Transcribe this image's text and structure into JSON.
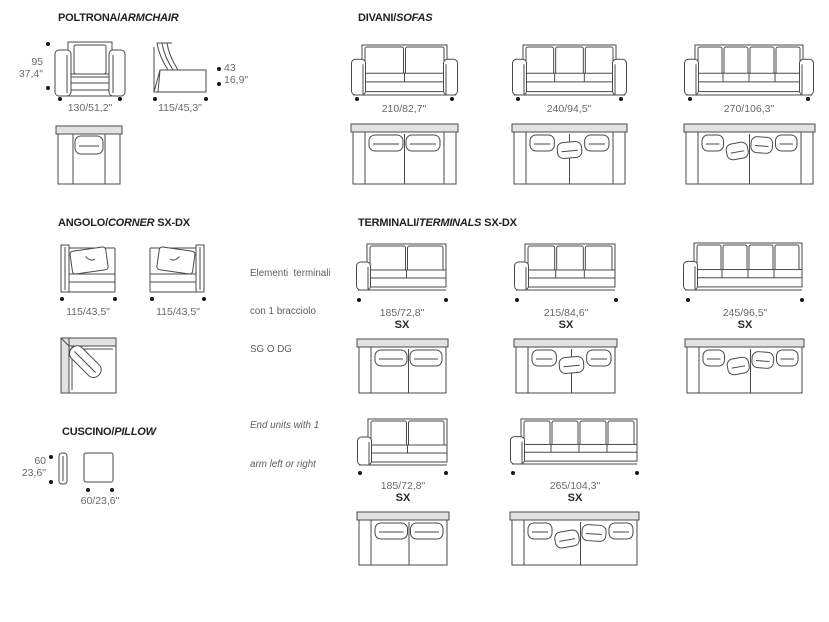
{
  "page": {
    "width": 829,
    "height": 622,
    "background": "#ffffff"
  },
  "colors": {
    "line": "#4a4a4b",
    "shade": "#e2e2e2",
    "text_gray": "#67686a",
    "text_dark": "#222222"
  },
  "sections": {
    "poltrona": {
      "title_main": "POLTRONA/",
      "title_italic": "ARMCHAIR",
      "title_suffix": ""
    },
    "divani": {
      "title_main": "DIVANI/",
      "title_italic": "SOFAS",
      "title_suffix": ""
    },
    "angolo": {
      "title_main": "ANGOLO/",
      "title_italic": "CORNER",
      "title_suffix": " SX-DX"
    },
    "terminali": {
      "title_main": "TERMINALI/",
      "title_italic": "TERMINALS",
      "title_suffix": " SX-DX"
    },
    "cuscino": {
      "title_main": "CUSCINO/",
      "title_italic": "PILLOW",
      "title_suffix": ""
    }
  },
  "note": {
    "it_lines": [
      "Elementi  terminali",
      "con 1 bracciolo",
      "SG O DG"
    ],
    "en_lines": [
      "End units with 1",
      "arm left or right"
    ]
  },
  "items": [
    {
      "id": "armchair-front",
      "kind": "front",
      "style": "armchair",
      "arms": "both",
      "cushions": 1,
      "label": "130/51,2\"",
      "side_lines": [
        "95",
        "37,4\""
      ]
    },
    {
      "id": "armchair-side",
      "kind": "side",
      "label": "115/45,3\"",
      "side_lines": [
        "43",
        "16,9\""
      ]
    },
    {
      "id": "armchair-top",
      "kind": "top",
      "style": "armchair",
      "arms": "both",
      "cushions": 1
    },
    {
      "id": "sofa-210-front",
      "kind": "front",
      "arms": "both",
      "cushions": 2,
      "label": "210/82,7\""
    },
    {
      "id": "sofa-210-top",
      "kind": "top",
      "arms": "both",
      "cushions": 2
    },
    {
      "id": "sofa-240-front",
      "kind": "front",
      "arms": "both",
      "cushions": 3,
      "label": "240/94,5\""
    },
    {
      "id": "sofa-240-top",
      "kind": "top",
      "arms": "both",
      "cushions": 3
    },
    {
      "id": "sofa-270-front",
      "kind": "front",
      "arms": "both",
      "cushions": 4,
      "label": "270/106,3\""
    },
    {
      "id": "sofa-270-top",
      "kind": "top",
      "arms": "both",
      "cushions": 4
    },
    {
      "id": "corner-sx-front",
      "kind": "corner",
      "mirror": false,
      "label": "115/43,5\""
    },
    {
      "id": "corner-dx-front",
      "kind": "corner",
      "mirror": true,
      "label": "115/43,5\""
    },
    {
      "id": "corner-top",
      "kind": "corner-top"
    },
    {
      "id": "terminal-185-front",
      "kind": "front",
      "arms": "left",
      "cushions": 2,
      "label": "185/72,8\"",
      "sx": "SX"
    },
    {
      "id": "terminal-185-top",
      "kind": "top",
      "arms": "left",
      "cushions": 2
    },
    {
      "id": "terminal-215-front",
      "kind": "front",
      "arms": "left",
      "cushions": 3,
      "label": "215/84,6\"",
      "sx": "SX"
    },
    {
      "id": "terminal-215-top",
      "kind": "top",
      "arms": "left",
      "cushions": 3
    },
    {
      "id": "terminal-245-front",
      "kind": "front",
      "arms": "left",
      "cushions": 4,
      "label": "245/96,5\"",
      "sx": "SX"
    },
    {
      "id": "terminal-245-top",
      "kind": "top",
      "arms": "left",
      "cushions": 4
    },
    {
      "id": "terminal2-185-front",
      "kind": "front",
      "arms": "left",
      "cushions": 2,
      "label": "185/72,8\"",
      "sx": "SX"
    },
    {
      "id": "terminal2-185-top",
      "kind": "top",
      "arms": "left",
      "cushions": 2
    },
    {
      "id": "terminal-265-front",
      "kind": "front",
      "arms": "left",
      "cushions": 4,
      "label": "265/104,3\"",
      "sx": "SX"
    },
    {
      "id": "terminal-265-top",
      "kind": "top",
      "arms": "left",
      "cushions": 4
    },
    {
      "id": "pillow-side",
      "kind": "pillow-side",
      "side_lines": [
        "60",
        "23,6\""
      ]
    },
    {
      "id": "pillow-front",
      "kind": "pillow-front",
      "label": "60/23,6\""
    }
  ]
}
